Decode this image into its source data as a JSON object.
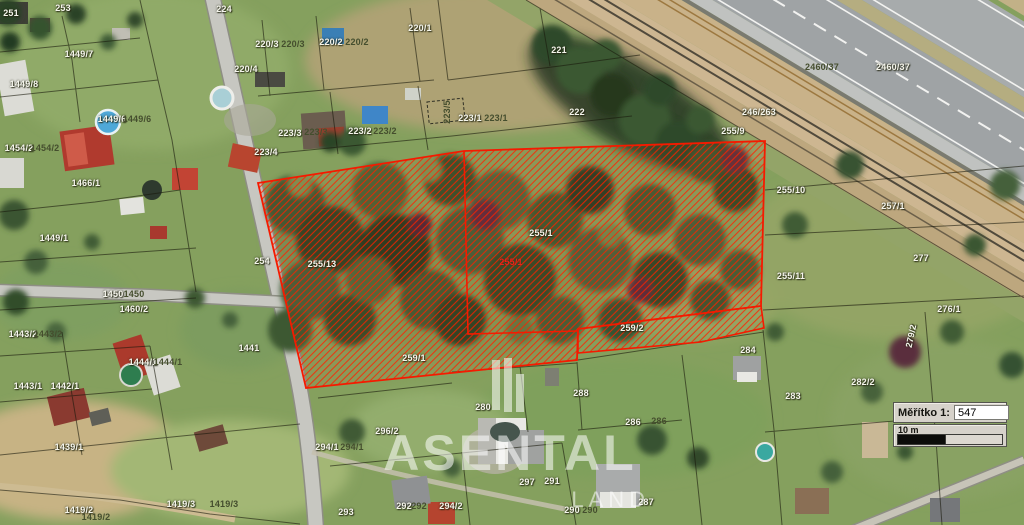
{
  "map": {
    "watermark": {
      "brand": "ASENTAL",
      "sub": "LAND"
    },
    "scale_widget": {
      "label": "Měřítko 1:",
      "value": "547",
      "unit_label": "10 m"
    },
    "colors": {
      "selection_red": "#f51a00",
      "label_white": "#f5f5ec",
      "label_dark": "#454e2e",
      "label_red": "#e8251a"
    },
    "parcel_labels": [
      {
        "text": "251",
        "x": 11,
        "y": 13
      },
      {
        "text": "253",
        "x": 63,
        "y": 8
      },
      {
        "text": "224",
        "x": 224,
        "y": 9
      },
      {
        "text": "1449/7",
        "x": 79,
        "y": 54
      },
      {
        "text": "1449/8",
        "x": 24,
        "y": 84
      },
      {
        "text": "1449/6",
        "x": 112,
        "y": 119
      },
      {
        "text": "1449/6",
        "x": 137,
        "y": 119,
        "v": "d"
      },
      {
        "text": "1454/2",
        "x": 19,
        "y": 148
      },
      {
        "text": "1454/2",
        "x": 45,
        "y": 148,
        "v": "d"
      },
      {
        "text": "1466/1",
        "x": 86,
        "y": 183
      },
      {
        "text": "1449/1",
        "x": 54,
        "y": 238
      },
      {
        "text": "1450",
        "x": 113,
        "y": 294
      },
      {
        "text": "1450",
        "x": 134,
        "y": 294,
        "v": "d"
      },
      {
        "text": "1460/2",
        "x": 134,
        "y": 309
      },
      {
        "text": "1443/2",
        "x": 23,
        "y": 334
      },
      {
        "text": "1443/2",
        "x": 48,
        "y": 334,
        "v": "d"
      },
      {
        "text": "1443/1",
        "x": 28,
        "y": 386
      },
      {
        "text": "1442/1",
        "x": 65,
        "y": 386
      },
      {
        "text": "1444/1",
        "x": 143,
        "y": 362
      },
      {
        "text": "1444/1",
        "x": 168,
        "y": 362,
        "v": "d"
      },
      {
        "text": "1441",
        "x": 249,
        "y": 348
      },
      {
        "text": "1439/1",
        "x": 69,
        "y": 447
      },
      {
        "text": "1419/2",
        "x": 79,
        "y": 510
      },
      {
        "text": "1419/2",
        "x": 96,
        "y": 517,
        "v": "d"
      },
      {
        "text": "1419/3",
        "x": 181,
        "y": 504
      },
      {
        "text": "1419/3",
        "x": 224,
        "y": 504,
        "v": "d"
      },
      {
        "text": "220/4",
        "x": 246,
        "y": 69
      },
      {
        "text": "220/3",
        "x": 267,
        "y": 44
      },
      {
        "text": "220/3",
        "x": 293,
        "y": 44,
        "v": "d"
      },
      {
        "text": "220/2",
        "x": 331,
        "y": 42
      },
      {
        "text": "220/2",
        "x": 357,
        "y": 42,
        "v": "d"
      },
      {
        "text": "220/1",
        "x": 420,
        "y": 28
      },
      {
        "text": "221",
        "x": 559,
        "y": 50
      },
      {
        "text": "222",
        "x": 577,
        "y": 112
      },
      {
        "text": "223/3",
        "x": 290,
        "y": 133
      },
      {
        "text": "223/3",
        "x": 316,
        "y": 132,
        "v": "d"
      },
      {
        "text": "223/2",
        "x": 360,
        "y": 131
      },
      {
        "text": "223/2",
        "x": 385,
        "y": 131,
        "v": "d"
      },
      {
        "text": "223/1",
        "x": 470,
        "y": 118
      },
      {
        "text": "223/1",
        "x": 496,
        "y": 118,
        "v": "d"
      },
      {
        "text": "223/4",
        "x": 266,
        "y": 152
      },
      {
        "text": "223/5",
        "x": 447,
        "y": 112,
        "v": "d",
        "r": -90
      },
      {
        "text": "2460/37",
        "x": 822,
        "y": 67,
        "v": "d"
      },
      {
        "text": "2460/37",
        "x": 893,
        "y": 67
      },
      {
        "text": "246/263",
        "x": 759,
        "y": 112
      },
      {
        "text": "255/9",
        "x": 733,
        "y": 131
      },
      {
        "text": "255/10",
        "x": 791,
        "y": 190
      },
      {
        "text": "257/1",
        "x": 893,
        "y": 206
      },
      {
        "text": "277",
        "x": 921,
        "y": 258
      },
      {
        "text": "255/11",
        "x": 791,
        "y": 276
      },
      {
        "text": "276/1",
        "x": 949,
        "y": 309
      },
      {
        "text": "279/2",
        "x": 911,
        "y": 336,
        "r": -78
      },
      {
        "text": "282/2",
        "x": 863,
        "y": 382
      },
      {
        "text": "283",
        "x": 793,
        "y": 396
      },
      {
        "text": "284",
        "x": 748,
        "y": 350
      },
      {
        "text": "254",
        "x": 262,
        "y": 261
      },
      {
        "text": "255/13",
        "x": 322,
        "y": 264
      },
      {
        "text": "255/1",
        "x": 541,
        "y": 233
      },
      {
        "text": "255/1",
        "x": 511,
        "y": 262,
        "v": "r"
      },
      {
        "text": "259/1",
        "x": 414,
        "y": 358
      },
      {
        "text": "259/2",
        "x": 632,
        "y": 328
      },
      {
        "text": "288",
        "x": 581,
        "y": 393
      },
      {
        "text": "280",
        "x": 483,
        "y": 407
      },
      {
        "text": "286",
        "x": 633,
        "y": 422
      },
      {
        "text": "286",
        "x": 659,
        "y": 421,
        "v": "d"
      },
      {
        "text": "296/2",
        "x": 387,
        "y": 431
      },
      {
        "text": "294/1",
        "x": 327,
        "y": 447
      },
      {
        "text": "294/1",
        "x": 352,
        "y": 447,
        "v": "d"
      },
      {
        "text": "293",
        "x": 346,
        "y": 512
      },
      {
        "text": "292",
        "x": 404,
        "y": 506
      },
      {
        "text": "292",
        "x": 419,
        "y": 506,
        "v": "d"
      },
      {
        "text": "294/2",
        "x": 451,
        "y": 506
      },
      {
        "text": "297",
        "x": 527,
        "y": 482
      },
      {
        "text": "291",
        "x": 552,
        "y": 481
      },
      {
        "text": "290",
        "x": 572,
        "y": 510
      },
      {
        "text": "290",
        "x": 590,
        "y": 510,
        "v": "d"
      },
      {
        "text": "287",
        "x": 646,
        "y": 502
      }
    ]
  }
}
